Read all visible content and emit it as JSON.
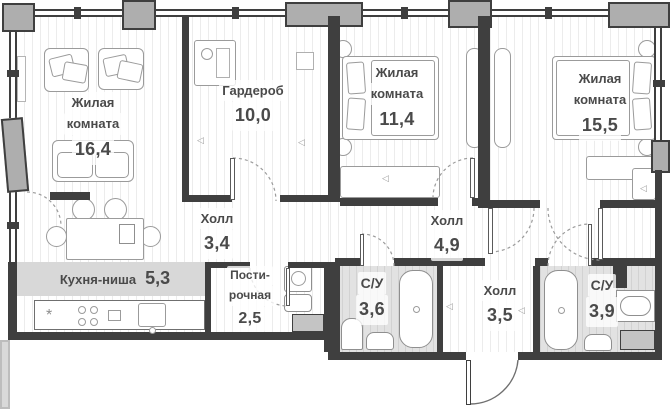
{
  "plan": {
    "type": "apartment-floor-plan",
    "language": "ru",
    "rooms": {
      "living": {
        "name_line1": "Жилая",
        "name_line2": "комната",
        "area": "16,4"
      },
      "wardrobe": {
        "name_line1": "Гардероб",
        "area": "10,0"
      },
      "bedroom_small": {
        "name_line1": "Жилая",
        "name_line2": "комната",
        "area": "11,4"
      },
      "bedroom_large": {
        "name_line1": "Жилая",
        "name_line2": "комната",
        "area": "15,5"
      },
      "hall_top": {
        "name_line1": "Холл",
        "area": "3,4"
      },
      "hall_middle": {
        "name_line1": "Холл",
        "area": "4,9"
      },
      "hall_entry": {
        "name_line1": "Холл",
        "area": "3,5"
      },
      "kitchen_niche": {
        "name_line1": "Кухня-ниша",
        "area": "5,3"
      },
      "laundry": {
        "name_line1": "Пости-",
        "name_line2": "рочная",
        "area": "2,5"
      },
      "bathroom_left": {
        "name_line1": "С/У",
        "area": "3,6"
      },
      "bathroom_right": {
        "name_line1": "С/У",
        "area": "3,9"
      }
    },
    "glyphs": {
      "door_marker": "◁",
      "cooktop_marker": "*"
    },
    "colors": {
      "wall": "#3f3f3f",
      "pillar": "#aeaeae",
      "floor_stripe": "#ececec",
      "wet_floor": "#e2e2e2",
      "kitchen_zone": "#d8d8d8",
      "label_text": "#4a4a4a",
      "furniture_outline": "#9b9b9b"
    }
  }
}
